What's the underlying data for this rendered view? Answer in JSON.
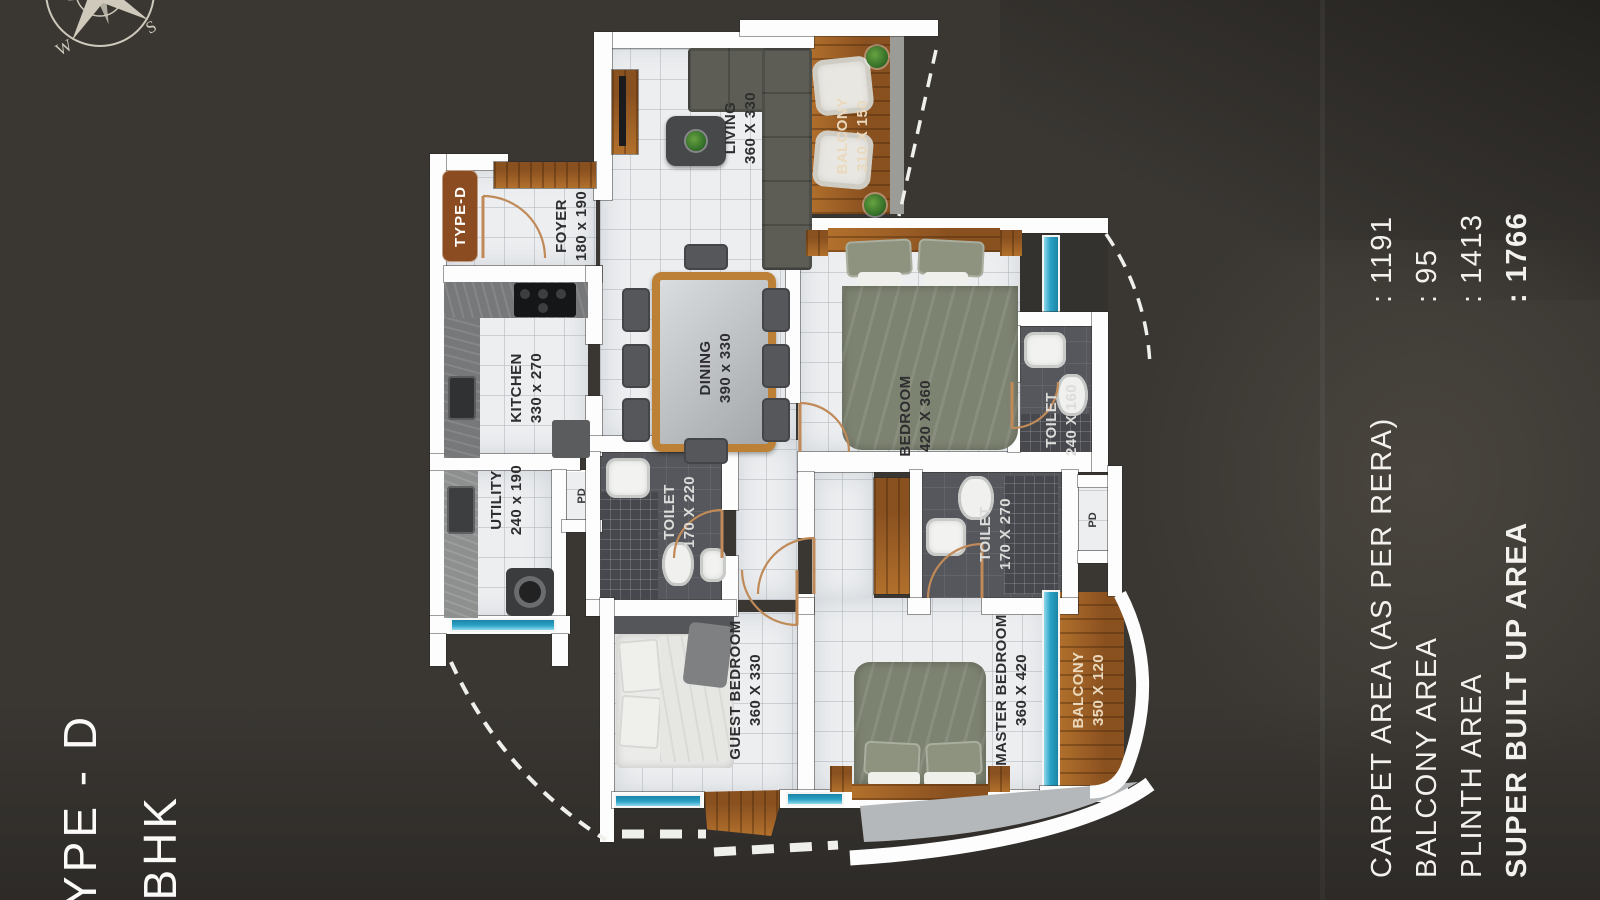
{
  "badge": "TYPE-D",
  "title": {
    "line1": "TYPE - D",
    "line2": "3BHK"
  },
  "compass": {
    "w": "W",
    "s": "S"
  },
  "rooms": [
    {
      "name": "LIVING",
      "dims": "360 X 330"
    },
    {
      "name": "BALCONY",
      "dims": "310 X 150"
    },
    {
      "name": "FOYER",
      "dims": "180 x 190"
    },
    {
      "name": "KITCHEN",
      "dims": "330 x 270"
    },
    {
      "name": "DINING",
      "dims": "390 x 330"
    },
    {
      "name": "BEDROOM",
      "dims": "420 X 360"
    },
    {
      "name": "TOILET",
      "dims": "240 X 160"
    },
    {
      "name": "UTILITY",
      "dims": "240 x 190"
    },
    {
      "name": "TOILET",
      "dims": "170 X 220"
    },
    {
      "name": "TOILET",
      "dims": "170 X 270"
    },
    {
      "name": "GUEST BEDROOM",
      "dims": "360 X 330"
    },
    {
      "name": "MASTER BEDROOM",
      "dims": "360 X 420"
    },
    {
      "name": "BALCONY",
      "dims": "350 X 120"
    }
  ],
  "ducts": [
    "PD",
    "PD"
  ],
  "stats": [
    {
      "label": "CARPET AREA (AS PER RERA)",
      "value": ": 1191"
    },
    {
      "label": "BALCONY AREA",
      "value": ": 95"
    },
    {
      "label": "PLINTH AREA",
      "value": ": 1413"
    },
    {
      "label": "SUPER BUILT UP AREA",
      "value": ": 1766"
    }
  ],
  "colors": {
    "background": "#3a3733",
    "wall": "#fdfdfd",
    "window_teal": "#2ba2c6",
    "wood": "#a1622a",
    "badge_brown": "#8a4c20",
    "label_dark": "#2e2e30",
    "label_cream": "#ead9bd",
    "text_white": "#f2f1ee"
  }
}
